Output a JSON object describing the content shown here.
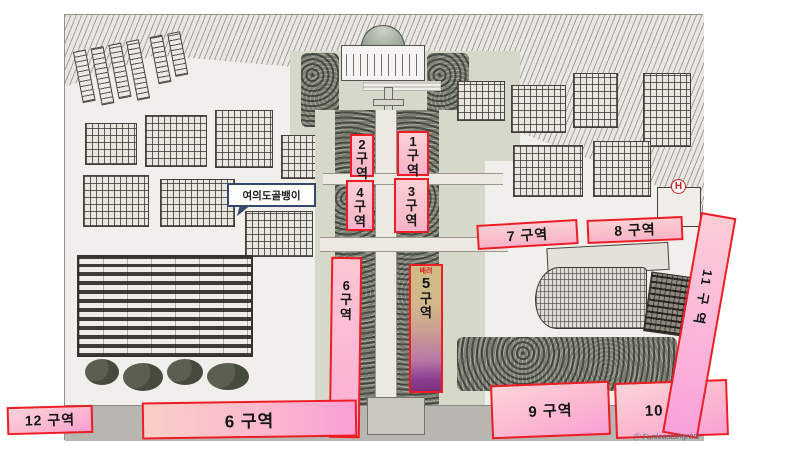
{
  "zones": {
    "z1": {
      "number": "1",
      "gu": "구",
      "yeok": "역"
    },
    "z2": {
      "number": "2",
      "gu": "구",
      "yeok": "역"
    },
    "z3": {
      "number": "3",
      "gu": "구",
      "yeok": "역"
    },
    "z4": {
      "number": "4",
      "gu": "구",
      "yeok": "역"
    },
    "z5": {
      "priority": "배려",
      "number": "5",
      "gu": "구",
      "yeok": "역"
    },
    "z6v": {
      "number": "6",
      "gu": "구",
      "yeok": "역"
    },
    "z6h": {
      "label": "6 구역"
    },
    "z7": {
      "label": "7 구역"
    },
    "z8": {
      "label": "8 구역"
    },
    "z9": {
      "label": "9 구역"
    },
    "z10": {
      "label": "10 구역"
    },
    "z11": {
      "label": "11 구 역"
    },
    "z12": {
      "label": "12 구역"
    }
  },
  "callout": {
    "text": "여의도골뱅이"
  },
  "building_marks": {
    "hospital": "H"
  },
  "signature": "Ⓟ Funleastangram",
  "colors": {
    "zone_border": "#ee1c24",
    "zone_fill": "#fbc0cd",
    "zone_fill_deep": "#fa9ed6",
    "zone5_top": "#cdbd86",
    "zone5_bottom": "#7a2f7e",
    "priority_text": "#e02020",
    "callout_border": "#35496d"
  }
}
